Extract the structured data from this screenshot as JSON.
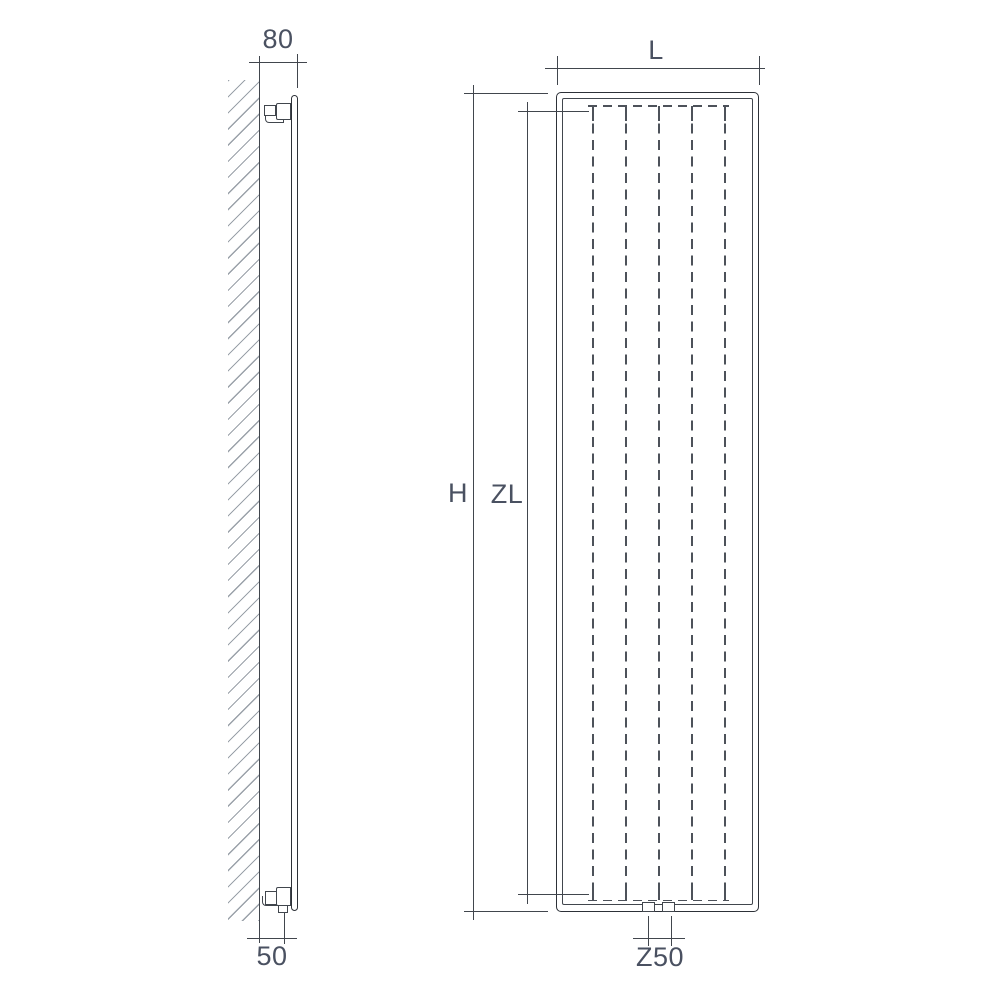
{
  "diagram": {
    "kind": "vertical-radiator-dimension-drawing",
    "views": {
      "side_view": {
        "name": "side view, wall mounted",
        "dimensions": {
          "wall_to_front": "80",
          "wall_to_connection": "50"
        }
      },
      "front_view": {
        "name": "front view",
        "dimensions": {
          "width": "L",
          "height": "H",
          "element_height": "ZL",
          "connection_spacing": "Z50"
        },
        "fin_count": 5,
        "bottom_connection_count": 2
      }
    },
    "colors": {
      "background": "#ffffff",
      "line": "#41464d",
      "border": "#2d3138",
      "dashed": "#4d525a",
      "hatch": "#9aa1a9",
      "text": "#4a5161"
    }
  }
}
